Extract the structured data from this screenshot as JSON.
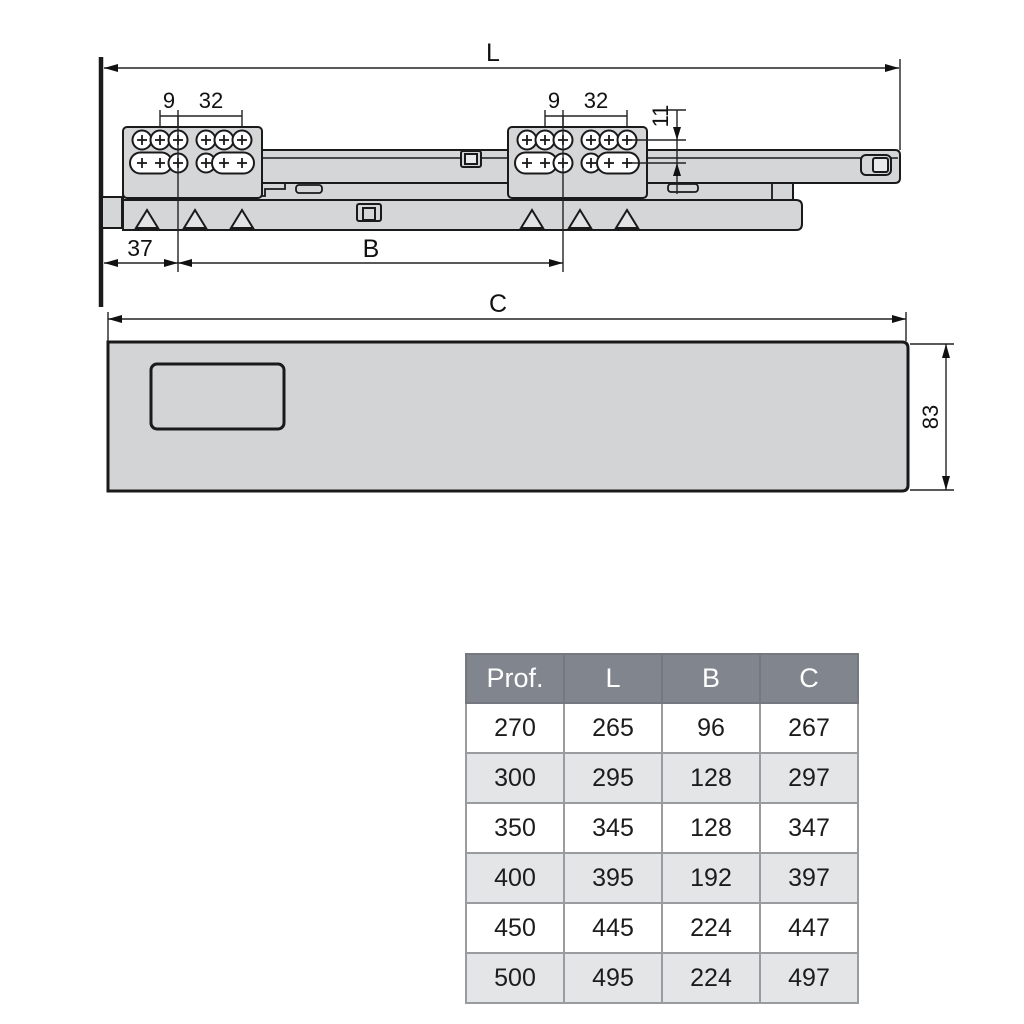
{
  "colors": {
    "fill_gray": "#d5d6d8",
    "fill_light": "#e9eaeb",
    "outline": "#1a1a1a",
    "dim_line": "#222222",
    "table_header_bg": "#81868e",
    "table_header_text": "#ffffff",
    "table_row_bg": "#ffffff",
    "table_row_alt_bg": "#e4e5e7",
    "table_text": "#1c1c1c"
  },
  "drawing": {
    "length_label": "L",
    "hole_pitch_label_left": "9",
    "system_pitch_label_left": "32",
    "hole_pitch_label_right": "9",
    "system_pitch_label_right": "32",
    "row_offset_label": "11",
    "front_offset_label": "37",
    "bracket_span_label": "B"
  },
  "panel": {
    "length_label": "C",
    "height_label": "83"
  },
  "table": {
    "headers": [
      "Prof.",
      "L",
      "B",
      "C"
    ],
    "rows": [
      [
        "270",
        "265",
        "96",
        "267"
      ],
      [
        "300",
        "295",
        "128",
        "297"
      ],
      [
        "350",
        "345",
        "128",
        "347"
      ],
      [
        "400",
        "395",
        "192",
        "397"
      ],
      [
        "450",
        "445",
        "224",
        "447"
      ],
      [
        "500",
        "495",
        "224",
        "497"
      ]
    ]
  }
}
